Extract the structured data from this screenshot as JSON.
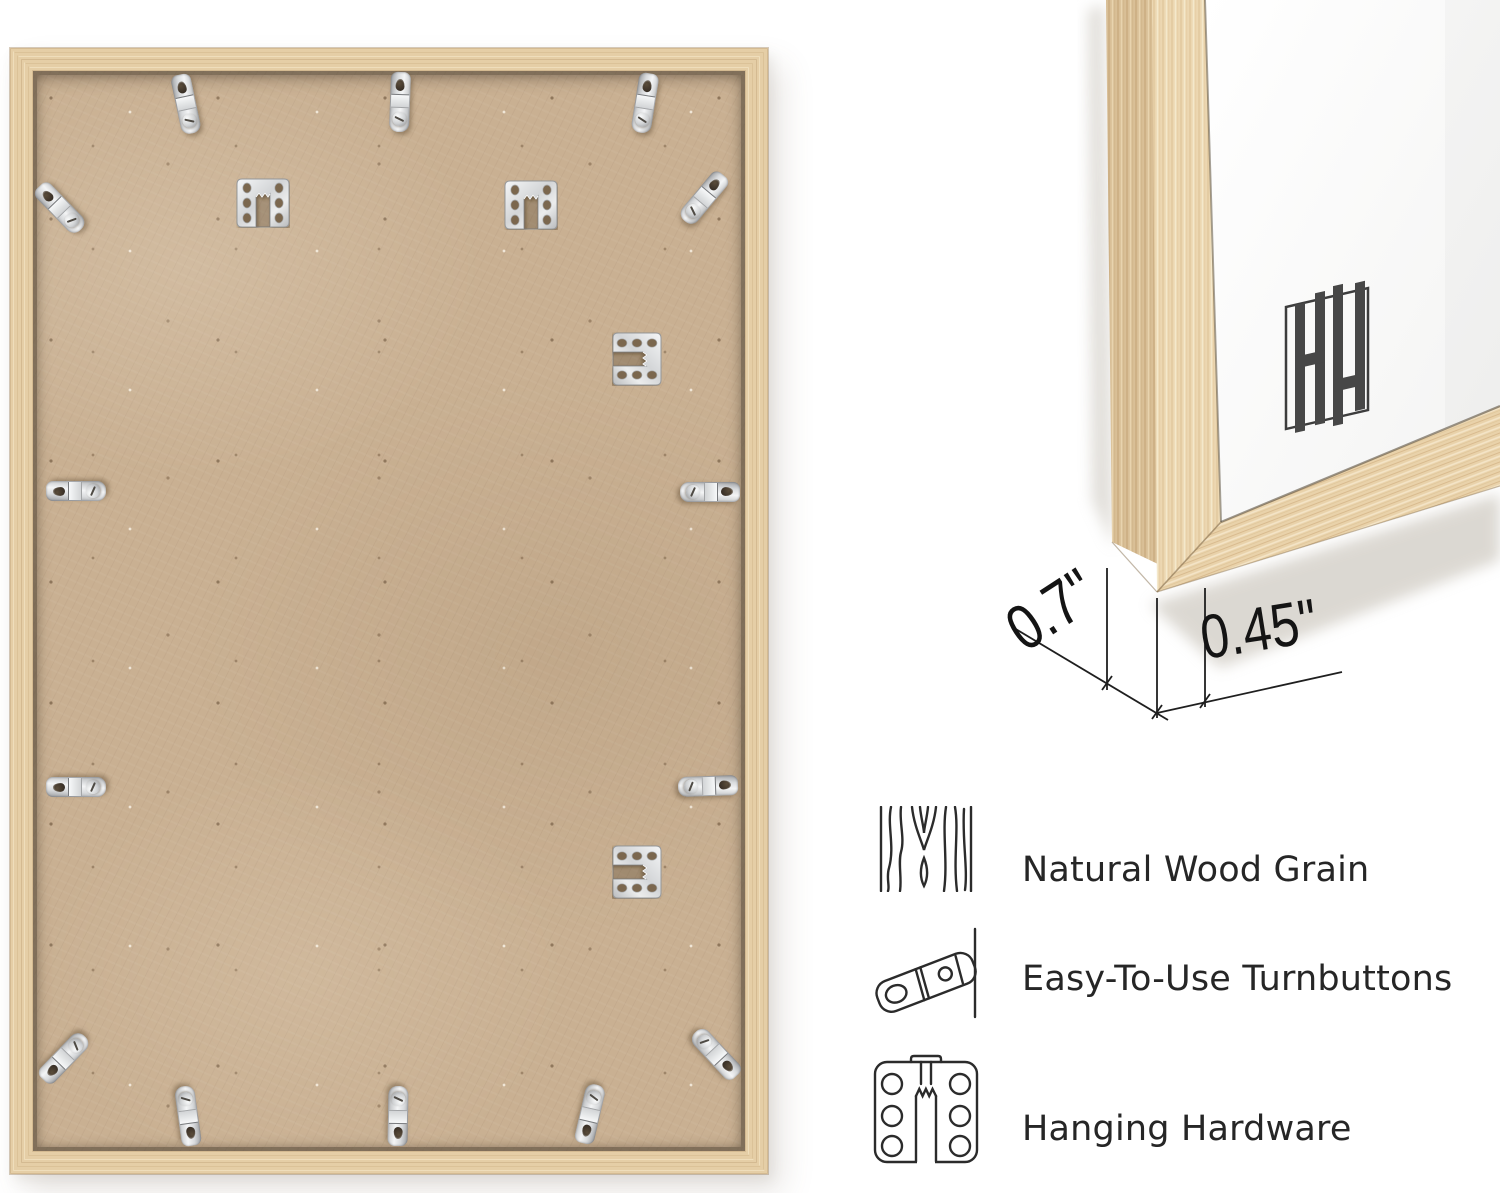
{
  "brand": {
    "monogram": "HH"
  },
  "dimensions": {
    "depth": "0.7\"",
    "face_width": "0.45\""
  },
  "features": [
    {
      "icon": "wood-grain-icon",
      "label": "Natural Wood Grain"
    },
    {
      "icon": "turnbutton-icon",
      "label": "Easy-To-Use Turnbuttons"
    },
    {
      "icon": "hanging-hardware-icon",
      "label": "Hanging Hardware"
    }
  ],
  "hardware": {
    "turnbuttons": 14,
    "sawtooth_hangers": 4
  },
  "colors": {
    "background": "#ffffff",
    "wood": "#e6cfa8",
    "wood_shadow": "#c9a977",
    "backing": "#c9b092",
    "metal": "#d7d9db",
    "ink": "#262626",
    "dimension_line": "#1f1f1f",
    "logo": "#454545"
  }
}
